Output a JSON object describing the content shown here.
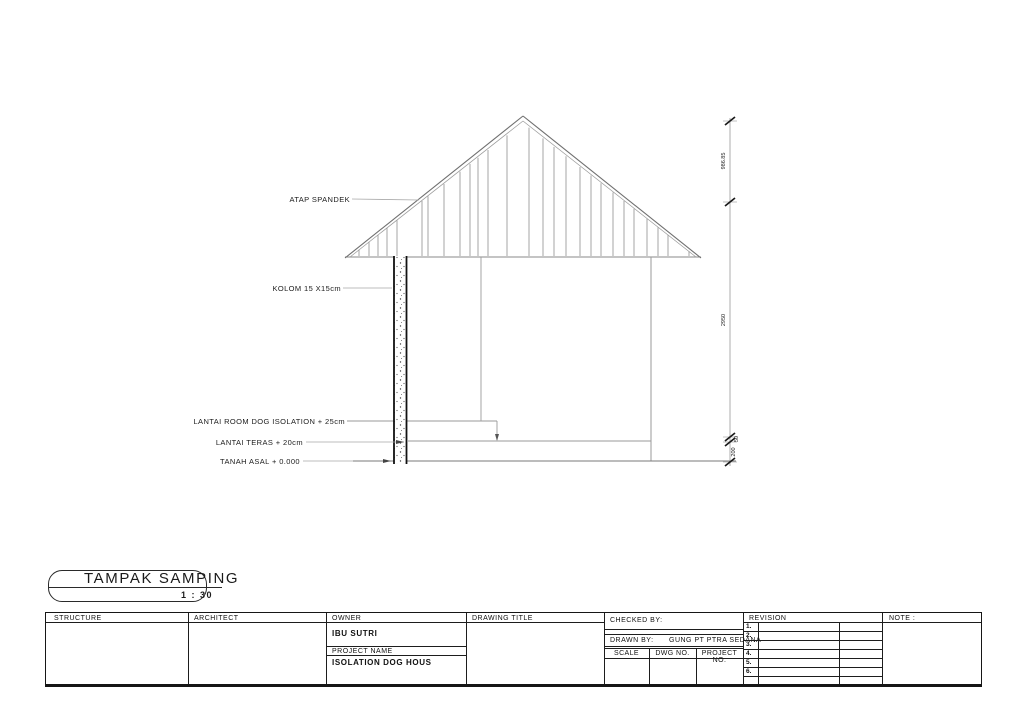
{
  "drawing": {
    "annotations": {
      "roof": "ATAP SPANDEK",
      "column": "KOLOM 15 X15cm",
      "floor_isolation": "LANTAI ROOM DOG ISOLATION + 25cm",
      "floor_teras": "LANTAI TERAS + 20cm",
      "ground": "TANAH ASAL + 0.000"
    },
    "dimensions": {
      "roof_height": "986.85",
      "wall_height": "2950",
      "floor_step": "50",
      "teras_height": "200"
    }
  },
  "view": {
    "title": "TAMPAK SAMPING",
    "scale": "1 : 30"
  },
  "title_block": {
    "structure_label": "STRUCTURE",
    "architect_label": "ARCHITECT",
    "owner_label": "OWNER",
    "owner_value": "IBU SUTRI",
    "project_name_label": "PROJECT NAME",
    "project_name_value": "ISOLATION DOG HOUS",
    "drawing_title_label": "DRAWING TITLE",
    "checked_by_label": "CHECKED BY:",
    "drawn_by_label": "DRAWN BY:",
    "drawn_by_value": "GUNG PT PTRA SEDANA",
    "scale_label": "SCALE",
    "dwg_no_label": "DWG NO.",
    "project_no_label": "PROJECT NO.",
    "revision_label": "REVISION",
    "revision_rows": [
      "1.",
      "2.",
      "3.",
      "4.",
      "5.",
      "6."
    ],
    "note_label": "NOTE :"
  }
}
